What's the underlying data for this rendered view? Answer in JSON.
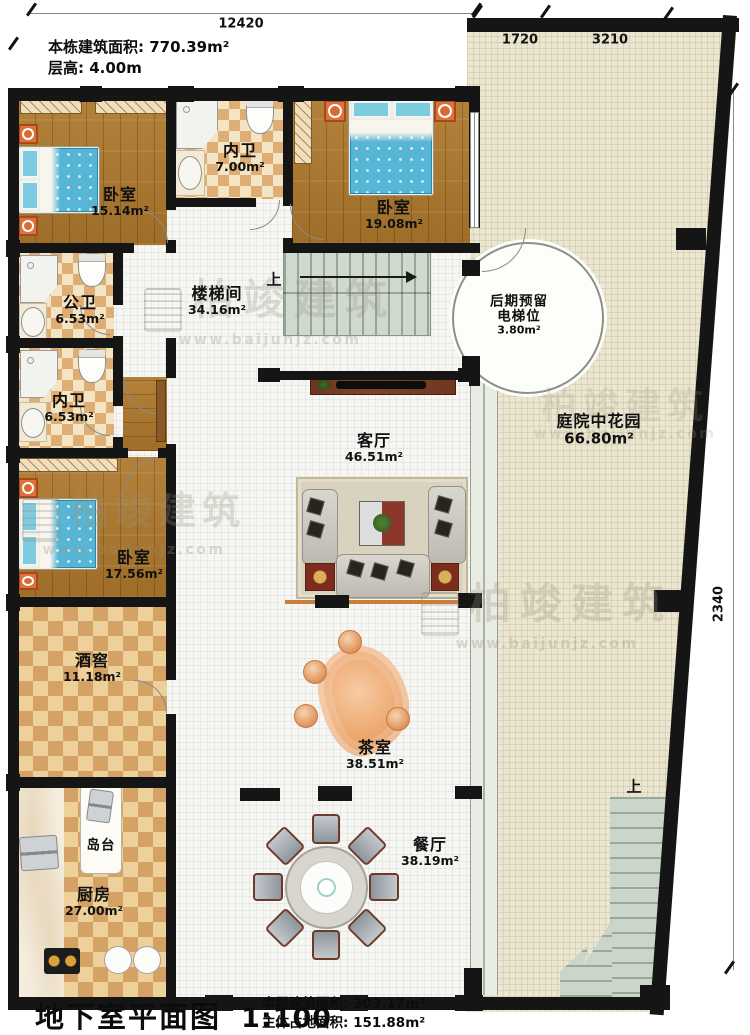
{
  "header": {
    "building_area": "本栋建筑面积: 770.39m²",
    "floor_height": "层高: 4.00m"
  },
  "title_block": {
    "title": "地下室平面图",
    "scale": "1:100",
    "floor_area": "本层建筑面积: 303.17m²",
    "footprint_area": "主体占地面积: 151.88m²"
  },
  "dimensions": {
    "top": "12420",
    "courtyard_seg1": "1720",
    "courtyard_seg2": "3210",
    "right": "2340"
  },
  "labels": {
    "up_indoor": "上",
    "up_outdoor": "上",
    "island": "岛台"
  },
  "watermark": {
    "brand": "柏竣建筑",
    "url": "www.baijunjz.com"
  },
  "rooms": {
    "bedroom1": {
      "name": "卧室",
      "area": "15.14m²"
    },
    "bath_inner1": {
      "name": "内卫",
      "area": "7.00m²"
    },
    "bedroom2": {
      "name": "卧室",
      "area": "19.08m²"
    },
    "bath_public": {
      "name": "公卫",
      "area": "6.53m²"
    },
    "stair_hall": {
      "name": "楼梯间",
      "area": "34.16m²"
    },
    "elevator": {
      "name": "后期预留电梯位",
      "area": "3.80m²"
    },
    "bath_inner2": {
      "name": "内卫",
      "area": "6.53m²"
    },
    "living": {
      "name": "客厅",
      "area": "46.51m²"
    },
    "courtyard": {
      "name": "庭院中花园",
      "area": "66.80m²"
    },
    "bedroom3": {
      "name": "卧室",
      "area": "17.56m²"
    },
    "wine_cellar": {
      "name": "酒窖",
      "area": "11.18m²"
    },
    "tea_room": {
      "name": "茶室",
      "area": "38.51m²"
    },
    "kitchen": {
      "name": "厨房",
      "area": "27.00m²"
    },
    "dining": {
      "name": "餐厅",
      "area": "38.19m²"
    }
  },
  "colors": {
    "wall": "#151515",
    "wood_floor": "#aa7830",
    "courtyard_floor": "#ebe6cf",
    "checker_accent": "#cd8034",
    "bed_blue": "#57b6d5",
    "tea_table_orange": "#e8965e"
  }
}
